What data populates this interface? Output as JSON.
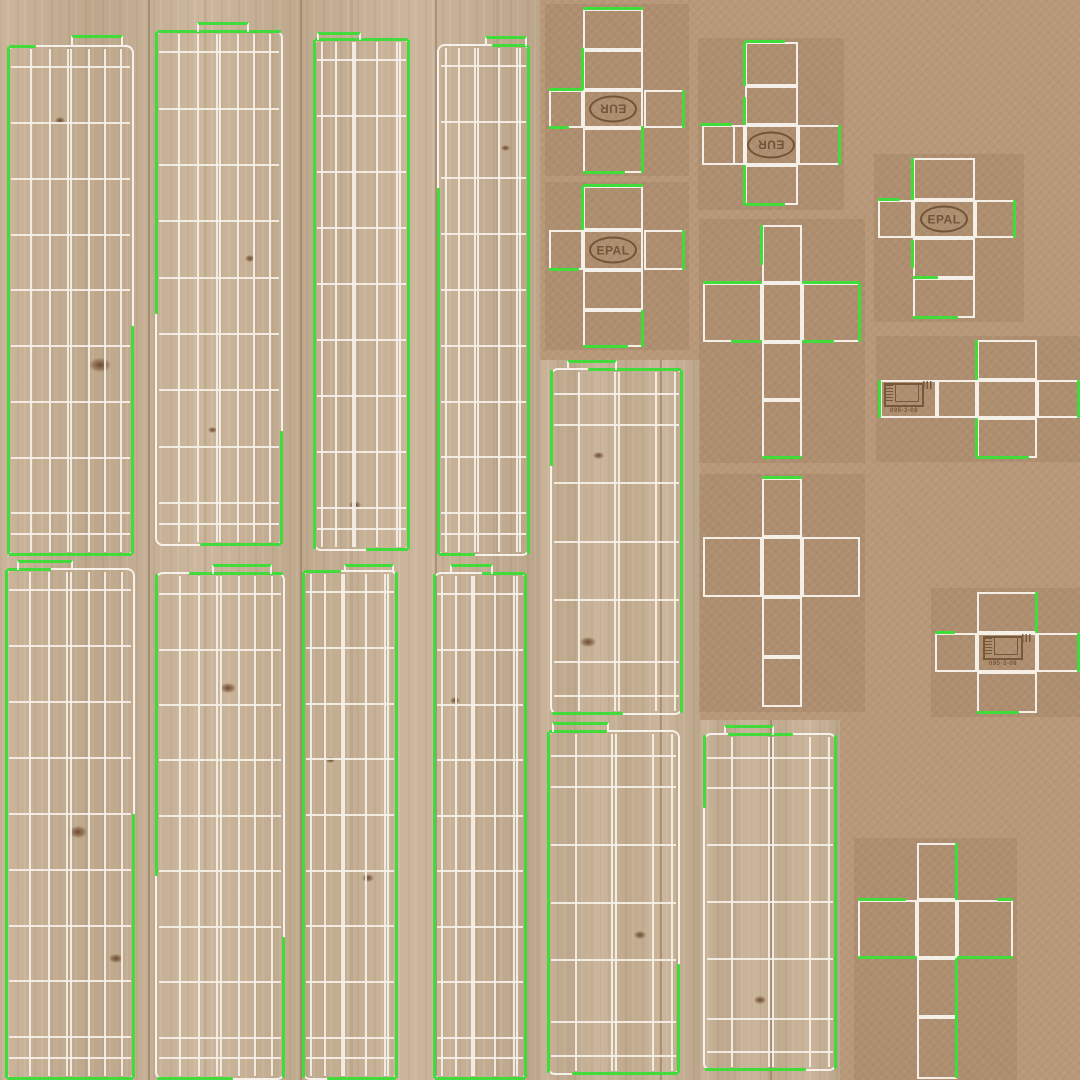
{
  "canvas": {
    "width": 1080,
    "height": 1080
  },
  "title": "pallet-uv-texture-atlas",
  "colors": {
    "cardboard": "#b89878",
    "shade": "rgba(90,60,35,0.10)",
    "wood": "#c7b093",
    "seam": "rgba(100,70,45,0.30)",
    "knot": "#6b4a33",
    "wire": "#f7f3ec",
    "green": "#3fdc3a",
    "stamp": "#6b4a2e"
  },
  "stamps": {
    "eur_label": "EUR",
    "epal_label": "EPAL",
    "cert_code": "095-3-08"
  },
  "background": {
    "wood_regions": [
      [
        0,
        0,
        540,
        1080
      ],
      [
        540,
        360,
        160,
        720
      ],
      [
        700,
        720,
        140,
        360
      ]
    ],
    "seams": [
      [
        148,
        0,
        1080
      ],
      [
        300,
        0,
        1080
      ],
      [
        435,
        0,
        1080
      ],
      [
        660,
        360,
        720
      ],
      [
        770,
        720,
        360
      ]
    ],
    "knots": [
      [
        100,
        365,
        22,
        14
      ],
      [
        228,
        688,
        16,
        10
      ],
      [
        78,
        832,
        18,
        12
      ],
      [
        116,
        958,
        14,
        9
      ],
      [
        368,
        878,
        12,
        8
      ],
      [
        588,
        642,
        16,
        10
      ],
      [
        640,
        935,
        12,
        8
      ],
      [
        250,
        258,
        10,
        7
      ],
      [
        505,
        148,
        9,
        6
      ],
      [
        355,
        505,
        12,
        8
      ],
      [
        212,
        430,
        9,
        6
      ],
      [
        455,
        700,
        10,
        7
      ],
      [
        598,
        455,
        11,
        7
      ],
      [
        760,
        1000,
        12,
        8
      ],
      [
        60,
        120,
        10,
        7
      ],
      [
        330,
        760,
        9,
        6
      ]
    ]
  },
  "row_presets": {
    "tall": [
      4,
      15,
      26,
      37,
      48,
      59,
      70,
      81,
      92,
      96
    ],
    "mid": [
      7,
      16,
      33,
      50,
      67,
      85,
      95
    ]
  },
  "col_presets": {
    "wide": [
      18,
      33,
      48,
      50.5,
      65,
      78,
      91
    ],
    "narrow": [
      8,
      23,
      41,
      43.5,
      67,
      88,
      91
    ],
    "mid": [
      21,
      49,
      52,
      81,
      95
    ]
  },
  "planks": [
    {
      "id": "p1",
      "x": 7,
      "y": 45,
      "w": 127,
      "h": 511,
      "rows": "tall",
      "cols": "wide",
      "tab": {
        "dx": 62,
        "w": 52,
        "h": 12
      },
      "greens": [
        [
          "left",
          0,
          100
        ],
        [
          "bottom",
          0,
          100
        ],
        [
          "top",
          0,
          22
        ],
        [
          "right",
          55,
          100
        ]
      ]
    },
    {
      "id": "p2",
      "x": 155,
      "y": 30,
      "w": 128,
      "h": 516,
      "rows": "tall",
      "cols": "wide",
      "tab": {
        "dx": 40,
        "w": 52,
        "h": 10
      },
      "greens": [
        [
          "top",
          0,
          100
        ],
        [
          "left",
          0,
          55
        ],
        [
          "right",
          78,
          100
        ],
        [
          "bottom",
          35,
          100
        ]
      ]
    },
    {
      "id": "p3",
      "x": 313,
      "y": 38,
      "w": 97,
      "h": 513,
      "rows": "tall",
      "cols": "narrow",
      "tab": {
        "dx": 2,
        "w": 44,
        "h": 8
      },
      "greens": [
        [
          "left",
          0,
          100
        ],
        [
          "top",
          0,
          100
        ],
        [
          "right",
          0,
          100
        ],
        [
          "bottom",
          55,
          100
        ]
      ]
    },
    {
      "id": "p4",
      "x": 437,
      "y": 44,
      "w": 93,
      "h": 512,
      "rows": "tall",
      "cols": "narrow",
      "tab": {
        "dx": 46,
        "w": 42,
        "h": 10
      },
      "greens": [
        [
          "right",
          0,
          100
        ],
        [
          "left",
          28,
          100
        ],
        [
          "top",
          60,
          100
        ],
        [
          "bottom",
          0,
          40
        ]
      ]
    },
    {
      "id": "p5",
      "x": 5,
      "y": 568,
      "w": 130,
      "h": 512,
      "rows": "tall",
      "cols": "wide",
      "tab": {
        "dx": 10,
        "w": 56,
        "h": 10
      },
      "greens": [
        [
          "left",
          0,
          100
        ],
        [
          "top",
          0,
          35
        ],
        [
          "right",
          48,
          100
        ],
        [
          "bottom",
          0,
          100
        ]
      ]
    },
    {
      "id": "p6",
      "x": 155,
      "y": 572,
      "w": 130,
      "h": 508,
      "rows": "tall",
      "cols": "wide",
      "tab": {
        "dx": 55,
        "w": 60,
        "h": 10
      },
      "greens": [
        [
          "top",
          25,
          100
        ],
        [
          "left",
          0,
          60
        ],
        [
          "right",
          72,
          100
        ],
        [
          "bottom",
          0,
          60
        ]
      ]
    },
    {
      "id": "p7",
      "x": 302,
      "y": 570,
      "w": 96,
      "h": 510,
      "rows": "tall",
      "cols": "narrow",
      "tab": {
        "dx": 40,
        "w": 50,
        "h": 8
      },
      "greens": [
        [
          "left",
          0,
          100
        ],
        [
          "right",
          0,
          100
        ],
        [
          "top",
          0,
          40
        ],
        [
          "bottom",
          25,
          100
        ]
      ]
    },
    {
      "id": "p8",
      "x": 433,
      "y": 572,
      "w": 94,
      "h": 508,
      "rows": "tall",
      "cols": "narrow",
      "tab": {
        "dx": 15,
        "w": 43,
        "h": 10
      },
      "greens": [
        [
          "left",
          0,
          100
        ],
        [
          "right",
          0,
          100
        ],
        [
          "top",
          52,
          100
        ],
        [
          "bottom",
          0,
          100
        ]
      ]
    },
    {
      "id": "p9",
      "x": 550,
      "y": 368,
      "w": 133,
      "h": 347,
      "rows": "mid",
      "cols": "mid",
      "tab": {
        "dx": 15,
        "w": 50,
        "h": 10
      },
      "greens": [
        [
          "right",
          0,
          100
        ],
        [
          "left",
          0,
          28
        ],
        [
          "top",
          28,
          100
        ],
        [
          "bottom",
          0,
          55
        ]
      ]
    },
    {
      "id": "p10",
      "x": 547,
      "y": 730,
      "w": 133,
      "h": 345,
      "rows": "mid",
      "cols": "mid",
      "tab": {
        "dx": 3,
        "w": 57,
        "h": 10
      },
      "greens": [
        [
          "left",
          0,
          100
        ],
        [
          "top",
          0,
          45
        ],
        [
          "bottom",
          18,
          100
        ],
        [
          "right",
          68,
          100
        ]
      ]
    },
    {
      "id": "p11",
      "x": 703,
      "y": 733,
      "w": 134,
      "h": 338,
      "rows": "mid",
      "cols": "mid",
      "tab": {
        "dx": 19,
        "w": 50,
        "h": 10
      },
      "greens": [
        [
          "right",
          0,
          100
        ],
        [
          "top",
          18,
          68
        ],
        [
          "bottom",
          0,
          78
        ],
        [
          "left",
          0,
          22
        ]
      ]
    }
  ],
  "crosses": [
    {
      "id": "c1",
      "shadow": [
        545,
        4,
        144,
        172
      ],
      "cells": [
        [
          583,
          9,
          60,
          41
        ],
        [
          583,
          50,
          60,
          40
        ],
        [
          549,
          90,
          34,
          38
        ],
        [
          583,
          90,
          60,
          38
        ],
        [
          644,
          90,
          41,
          38
        ],
        [
          583,
          128,
          60,
          45
        ]
      ],
      "greens": [
        [
          583,
          7,
          60,
          3
        ],
        [
          549,
          88,
          34,
          3
        ],
        [
          682,
          90,
          3,
          38
        ],
        [
          641,
          126,
          3,
          47
        ],
        [
          583,
          171,
          42,
          3
        ],
        [
          581,
          48,
          3,
          42
        ],
        [
          549,
          126,
          20,
          3
        ]
      ],
      "stamp": {
        "kind": "eur",
        "x": 613,
        "y": 109,
        "rot": 180
      }
    },
    {
      "id": "c2",
      "shadow": [
        545,
        182,
        144,
        168
      ],
      "cells": [
        [
          583,
          186,
          60,
          44
        ],
        [
          549,
          230,
          34,
          40
        ],
        [
          583,
          230,
          60,
          40
        ],
        [
          644,
          230,
          41,
          40
        ],
        [
          583,
          270,
          60,
          40
        ],
        [
          583,
          310,
          60,
          37
        ]
      ],
      "greens": [
        [
          583,
          184,
          60,
          3
        ],
        [
          682,
          230,
          3,
          40
        ],
        [
          549,
          268,
          30,
          3
        ],
        [
          641,
          310,
          3,
          37
        ],
        [
          583,
          345,
          45,
          3
        ],
        [
          581,
          186,
          3,
          44
        ]
      ],
      "stamp": {
        "kind": "epal",
        "x": 613,
        "y": 250,
        "rot": 0
      }
    },
    {
      "id": "c3",
      "shadow": [
        698,
        38,
        146,
        172
      ],
      "cells": [
        [
          745,
          42,
          53,
          44
        ],
        [
          745,
          86,
          53,
          39
        ],
        [
          702,
          125,
          43,
          40
        ],
        [
          733,
          125,
          12,
          40
        ],
        [
          745,
          125,
          53,
          40
        ],
        [
          798,
          125,
          42,
          40
        ],
        [
          745,
          165,
          53,
          40
        ]
      ],
      "greens": [
        [
          743,
          42,
          3,
          44
        ],
        [
          743,
          97,
          3,
          28
        ],
        [
          700,
          123,
          32,
          3
        ],
        [
          838,
          125,
          3,
          40
        ],
        [
          743,
          165,
          3,
          40
        ],
        [
          745,
          203,
          40,
          3
        ],
        [
          745,
          40,
          40,
          3
        ]
      ],
      "stamp": {
        "kind": "eur",
        "x": 771,
        "y": 145,
        "rot": 180
      }
    },
    {
      "id": "c4",
      "shadow": [
        874,
        154,
        150,
        168
      ],
      "cells": [
        [
          913,
          158,
          62,
          42
        ],
        [
          878,
          200,
          35,
          38
        ],
        [
          913,
          200,
          62,
          38
        ],
        [
          975,
          200,
          40,
          38
        ],
        [
          913,
          238,
          62,
          40
        ],
        [
          913,
          278,
          62,
          40
        ]
      ],
      "greens": [
        [
          911,
          158,
          3,
          42
        ],
        [
          1013,
          200,
          3,
          38
        ],
        [
          911,
          240,
          3,
          28
        ],
        [
          913,
          276,
          25,
          3
        ],
        [
          913,
          316,
          45,
          3
        ],
        [
          878,
          198,
          22,
          3
        ]
      ],
      "stamp": {
        "kind": "epal",
        "x": 944,
        "y": 219,
        "rot": 0
      }
    },
    {
      "id": "c5",
      "shadow": [
        699,
        219,
        166,
        244
      ],
      "cells": [
        [
          762,
          225,
          40,
          58
        ],
        [
          703,
          283,
          59,
          59
        ],
        [
          762,
          283,
          40,
          59
        ],
        [
          802,
          283,
          58,
          59
        ],
        [
          762,
          342,
          40,
          58
        ],
        [
          762,
          400,
          40,
          58
        ]
      ],
      "greens": [
        [
          703,
          281,
          59,
          3
        ],
        [
          802,
          281,
          58,
          3
        ],
        [
          858,
          283,
          3,
          59
        ],
        [
          731,
          340,
          31,
          3
        ],
        [
          802,
          340,
          32,
          3
        ],
        [
          762,
          456,
          40,
          3
        ],
        [
          760,
          225,
          3,
          40
        ]
      ]
    },
    {
      "id": "c6",
      "shadow": [
        699,
        474,
        166,
        238
      ],
      "cells": [
        [
          762,
          478,
          40,
          59
        ],
        [
          703,
          537,
          59,
          60
        ],
        [
          762,
          537,
          40,
          60
        ],
        [
          802,
          537,
          58,
          60
        ],
        [
          762,
          597,
          40,
          60
        ],
        [
          762,
          657,
          40,
          50
        ]
      ],
      "greens": [
        [
          762,
          476,
          40,
          3
        ]
      ]
    },
    {
      "id": "c7",
      "shadow": [
        854,
        838,
        163,
        242
      ],
      "cells": [
        [
          917,
          843,
          40,
          57
        ],
        [
          858,
          900,
          59,
          58
        ],
        [
          917,
          900,
          40,
          58
        ],
        [
          957,
          900,
          56,
          58
        ],
        [
          917,
          958,
          40,
          59
        ],
        [
          917,
          1017,
          40,
          62
        ]
      ],
      "greens": [
        [
          955,
          843,
          3,
          57
        ],
        [
          858,
          898,
          48,
          3
        ],
        [
          997,
          898,
          16,
          3
        ],
        [
          858,
          956,
          59,
          3
        ],
        [
          957,
          956,
          56,
          3
        ],
        [
          955,
          958,
          3,
          120
        ]
      ]
    },
    {
      "id": "c8",
      "shadow": [
        876,
        336,
        204,
        126
      ],
      "cells": [
        [
          977,
          340,
          60,
          40
        ],
        [
          880,
          380,
          57,
          38
        ],
        [
          937,
          380,
          40,
          38
        ],
        [
          977,
          380,
          60,
          38
        ],
        [
          1037,
          380,
          44,
          38
        ],
        [
          977,
          418,
          60,
          40
        ]
      ],
      "greens": [
        [
          975,
          340,
          3,
          40
        ],
        [
          878,
          380,
          3,
          38
        ],
        [
          1077,
          380,
          3,
          38
        ],
        [
          975,
          418,
          3,
          40
        ],
        [
          977,
          456,
          52,
          3
        ]
      ],
      "stamp": {
        "kind": "cert",
        "x": 908,
        "y": 399,
        "rot": 0
      }
    },
    {
      "id": "c9",
      "shadow": [
        931,
        588,
        149,
        129
      ],
      "cells": [
        [
          977,
          592,
          60,
          41
        ],
        [
          935,
          633,
          42,
          39
        ],
        [
          977,
          633,
          60,
          39
        ],
        [
          1037,
          633,
          44,
          39
        ],
        [
          977,
          672,
          60,
          41
        ]
      ],
      "greens": [
        [
          1035,
          592,
          3,
          41
        ],
        [
          1077,
          633,
          3,
          39
        ],
        [
          977,
          711,
          42,
          3
        ],
        [
          935,
          631,
          20,
          3
        ]
      ],
      "stamp": {
        "kind": "cert",
        "x": 1007,
        "y": 652,
        "rot": 0
      }
    }
  ]
}
